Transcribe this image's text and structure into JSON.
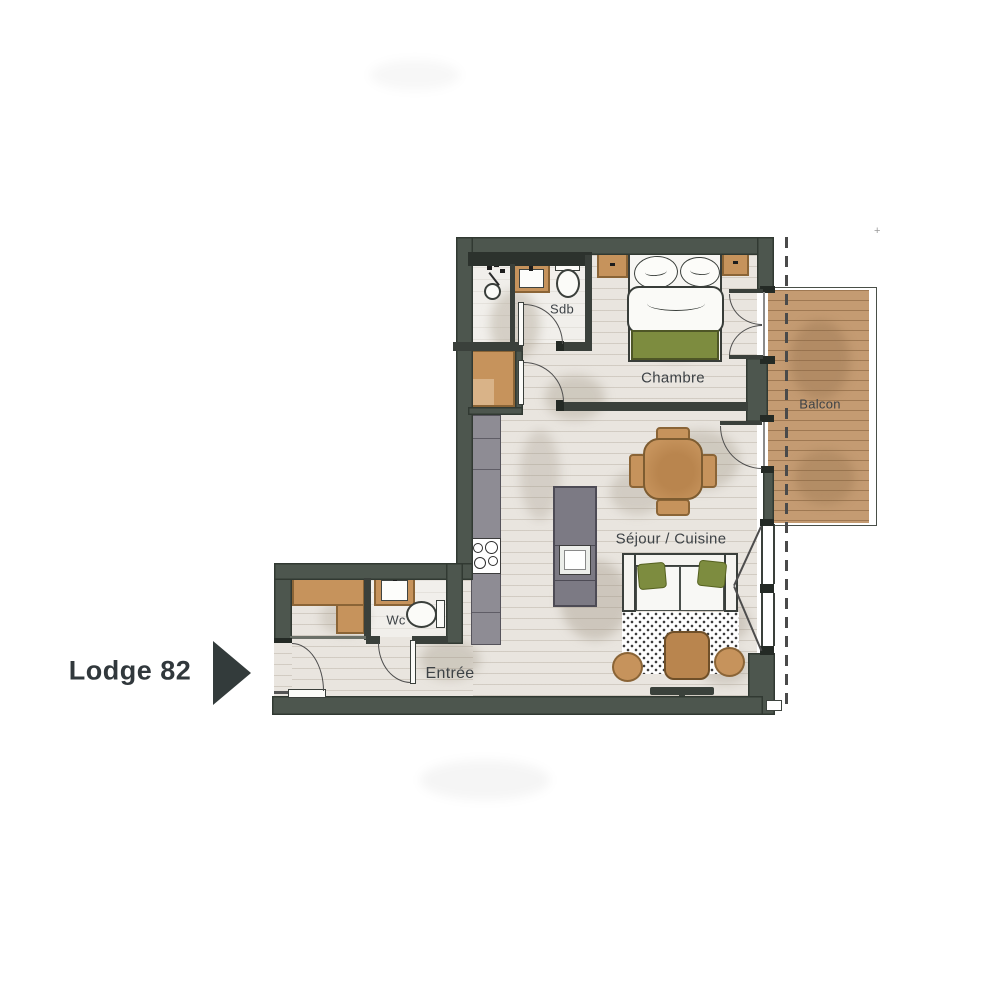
{
  "plan_title": {
    "label": "Lodge 82"
  },
  "rooms": {
    "sdb": "Sdb",
    "chambre": "Chambre",
    "balcon": "Balcon",
    "sejour_cuisine": "Séjour / Cuisine",
    "wc": "Wc",
    "entree": "Entrée"
  },
  "marks": {
    "registration": "+"
  },
  "colors": {
    "wall": "#4d564e",
    "interior-wall": "#3a403b",
    "floor": "#e9e5df",
    "floor-light": "#f1efeb",
    "deck": "#c49b72",
    "wood": "#c6935c",
    "wood-border": "#8a6436",
    "counter": "#8e8c94",
    "island": "#7c7a84",
    "green": "#7d8c3f",
    "line": "#4d4d4d",
    "text": "#3d4246",
    "title-text": "#31383c"
  }
}
